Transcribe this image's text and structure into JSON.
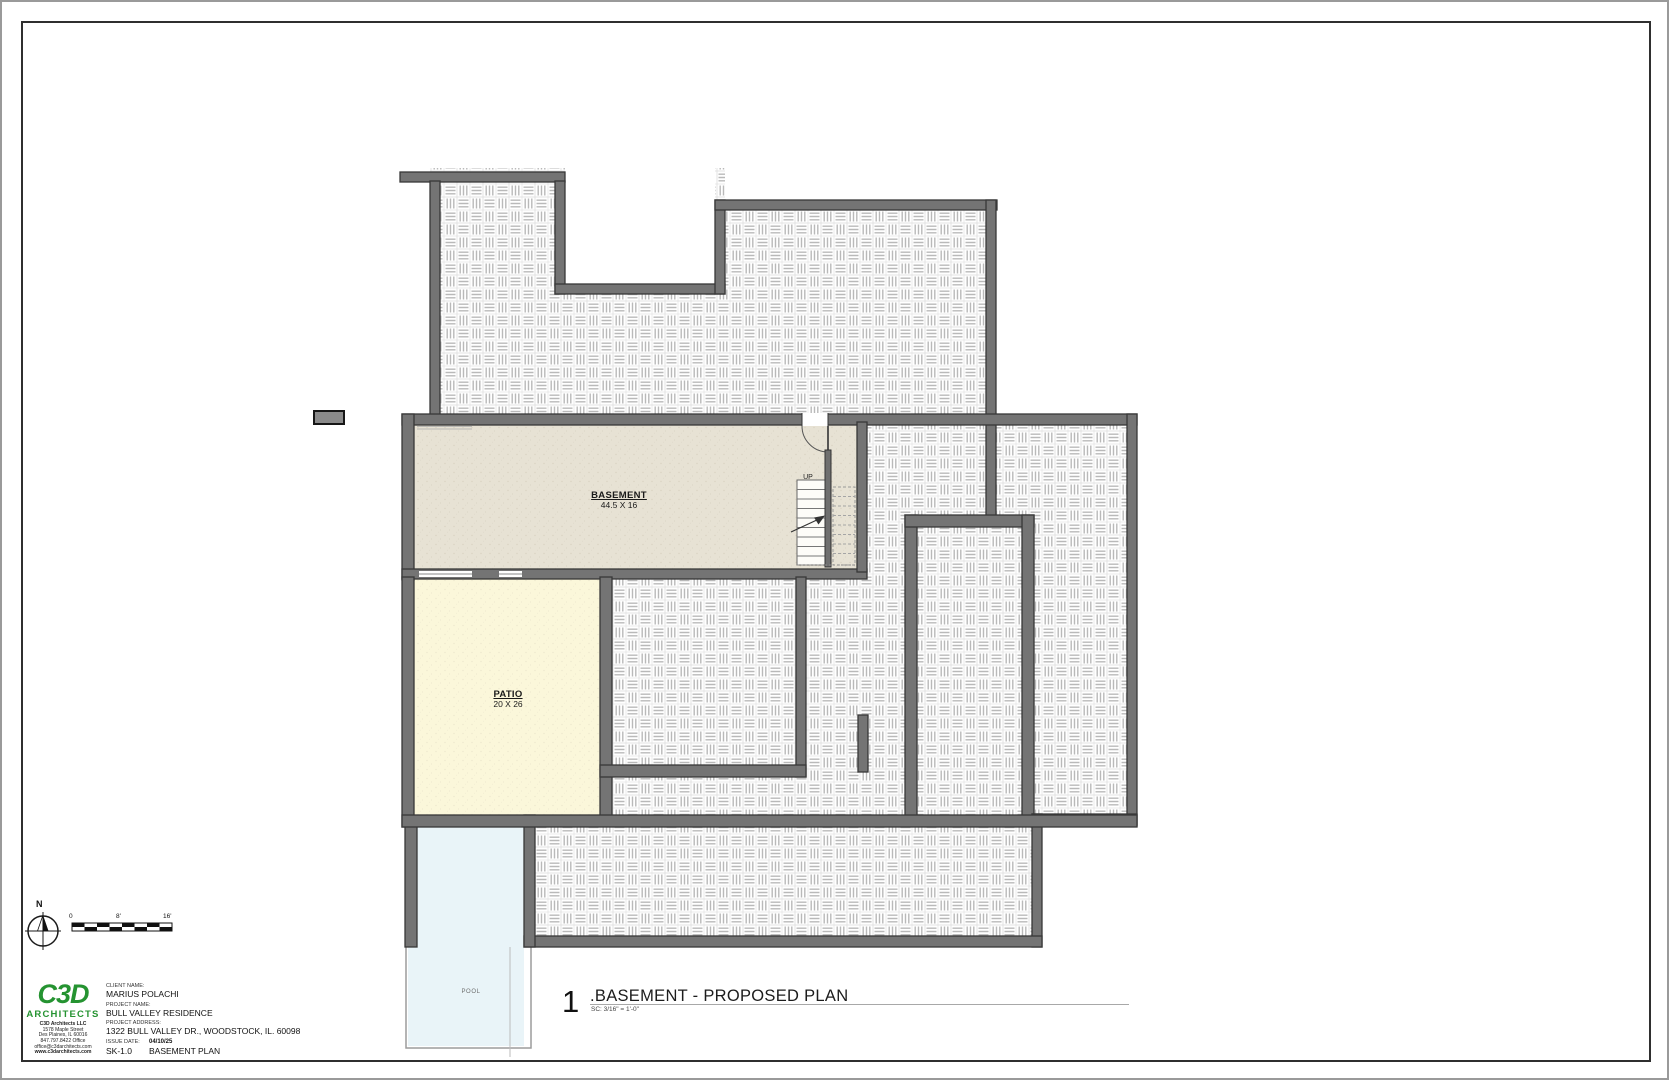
{
  "sheet": {
    "rooms": {
      "basement": {
        "name": "BASEMENT",
        "dims": "44.5 X 16"
      },
      "patio": {
        "name": "PATIO",
        "dims": "20 X 26"
      },
      "pool": {
        "name": "POOL"
      }
    },
    "stair": {
      "up_label": "UP"
    },
    "drawing_title": {
      "number": "1",
      "text": ".BASEMENT - PROPOSED PLAN",
      "scale": "SC:  3/16\" = 1'-0\""
    },
    "scale_bar": {
      "zero": "0",
      "mid": "8'",
      "end": "16'"
    },
    "north": {
      "label": "N"
    },
    "title_block": {
      "logo": {
        "brand": "C3D",
        "subbrand": "ARCHITECTS",
        "firm": "C3D Architects LLC",
        "address1": "1578 Maple Street",
        "address2": "Des Plaines, IL 60016",
        "phone": "847.797.8422 Office",
        "email": "office@c3darchitects.com",
        "website": "www.c3darchitects.com"
      },
      "client_label": "CLIENT NAME:",
      "client": "MARIUS POLACHI",
      "project_label": "PROJECT NAME:",
      "project": "BULL VALLEY RESIDENCE",
      "address_label": "PROJECT ADDRESS:",
      "address": "1322 BULL VALLEY DR., WOODSTOCK, IL. 60098",
      "issue_label": "ISSUE DATE:",
      "issue_date": "04/10/25",
      "sheet_number": "SK-1.0",
      "sheet_name": "BASEMENT PLAN"
    },
    "colors": {
      "wall": "#747474",
      "wall_edge": "#383838",
      "basement_fill": "#e7e2d4",
      "patio_fill": "#fbf7da",
      "pool_fill": "#e9f4f8",
      "hatch_line": "#b9b9b9",
      "logo_green": "#259331"
    }
  }
}
